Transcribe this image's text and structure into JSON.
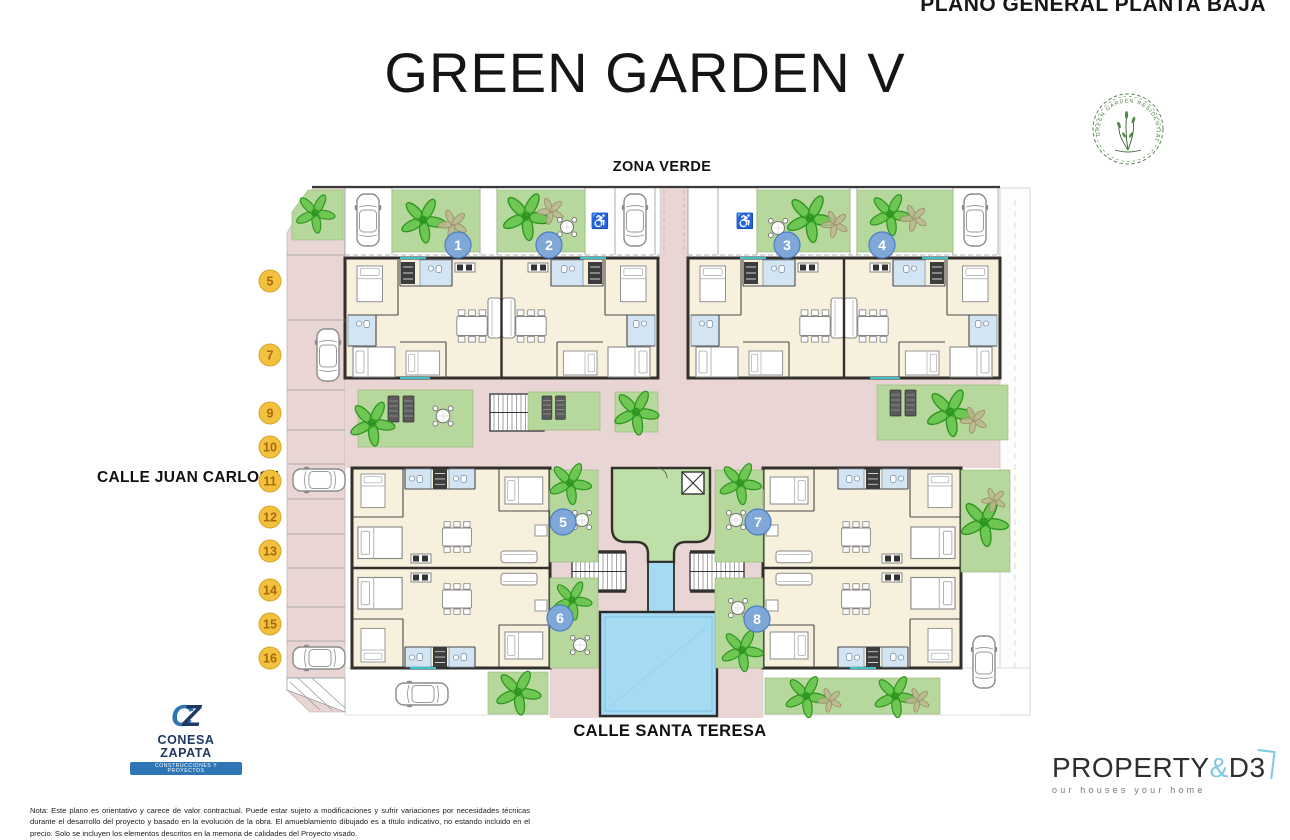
{
  "header": {
    "plan_label": "PLANO GENERAL PLANTA BAJA",
    "title": "GREEN GARDEN V"
  },
  "badge": {
    "text": "GREEN GARDEN RESIDENTIAL"
  },
  "plan": {
    "zona_verde": "ZONA VERDE",
    "street_left": "CALLE JUAN CARLOS I",
    "street_bottom": "CALLE SANTA TERESA",
    "handicap_icon": "♿",
    "units": [
      "1",
      "2",
      "3",
      "4",
      "5",
      "6",
      "7",
      "8"
    ],
    "parking": [
      "5",
      "7",
      "9",
      "10",
      "11",
      "12",
      "13",
      "14",
      "15",
      "16"
    ]
  },
  "colors": {
    "street_pink": "#e9d6d4",
    "garden_green": "#b7d89c",
    "common_building_green": "#bfdfa8",
    "pool_blue": "#a5daf2",
    "room_cream": "#f7f0dd",
    "bath_blue": "#d3e5f2",
    "wall_dark": "#332f2b",
    "unit_badge_blue": "#7fa8d9",
    "parking_badge_yellow": "#f2c23e",
    "window_teal": "#3fc1c9",
    "logo_green": "#4a7a42",
    "brand_navy": "#203864",
    "brand_blue": "#2e75b6",
    "accent_sky": "#7ec8e3"
  },
  "footer": {
    "builder": {
      "monogram_c": "C",
      "monogram_z": "Z",
      "name": "CONESA ZAPATA",
      "tagline": "CONSTRUCCIONES Y PROYECTOS"
    },
    "agency": {
      "brand_main": "PROPERTY",
      "brand_amp": "&",
      "brand_sub": "D3",
      "tagline": "our houses your home"
    },
    "note": "Nota: Este plano es orientativo y carece de valor contractual. Puede estar sujeto a modificaciones y sufrir variaciones por necesidades técnicas durante el desarrollo del proyecto y basado en la evolución de la obra. El amueblamiento dibujado es a título indicativo, no estando incluido en el precio. Solo se incluyen los elementos descritos en la memoria de calidades del Proyecto visado."
  }
}
